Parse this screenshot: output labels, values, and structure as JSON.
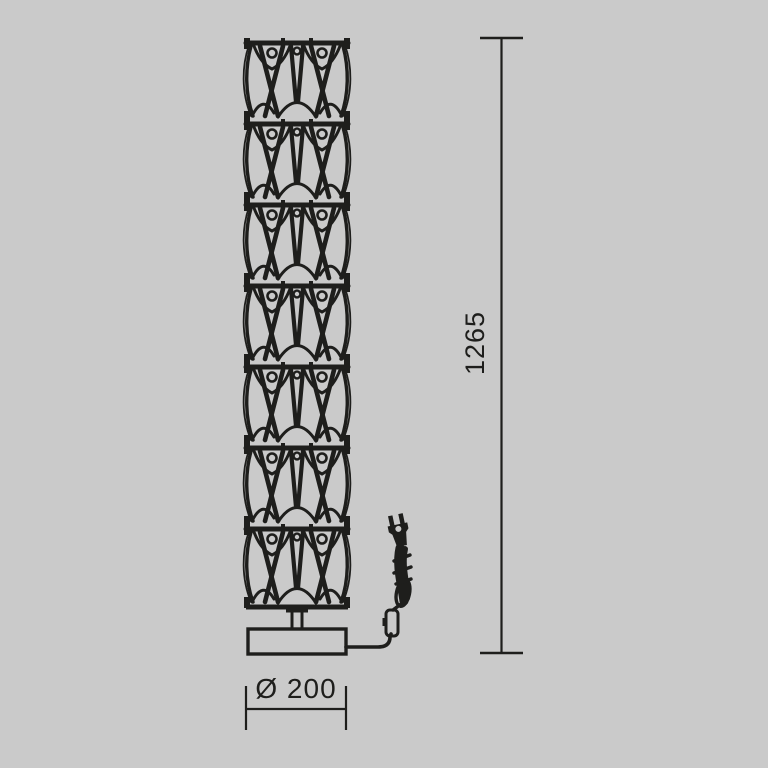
{
  "diagram": {
    "type": "product-dimension-drawing",
    "subject": "crystal-module floor lamp, front elevation",
    "background_color": "#cacaca",
    "line_color": "#1e1e1c",
    "lamp": {
      "module_count": 7,
      "parts": [
        "stacked-openwork-modules",
        "stem",
        "base",
        "power-cord",
        "inline-switch",
        "cord-coil",
        "power-plug"
      ]
    },
    "dimensions": {
      "height": {
        "value": "1265",
        "orientation": "vertical"
      },
      "diameter": {
        "value": "Ø 200",
        "orientation": "horizontal"
      }
    }
  }
}
